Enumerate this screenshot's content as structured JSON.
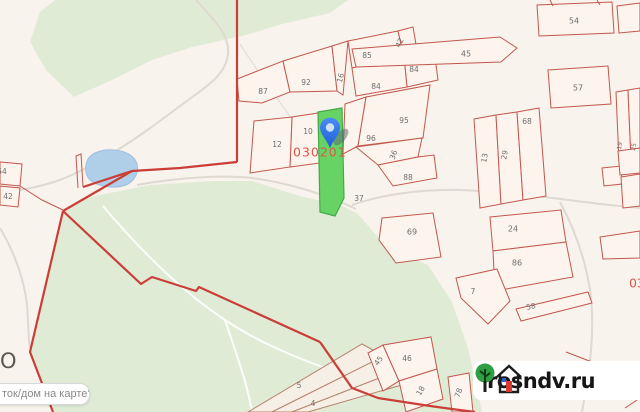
{
  "map": {
    "colors": {
      "background": "#f8f3ec",
      "forest_green": "#e0ebd6",
      "water_blue": "#afcfe9",
      "parcel_line_red": "#c2574e",
      "boundary_red": "#cb3e38",
      "brown_line": "#b5836b",
      "highlight_green": "#68d365",
      "highlight_border": "#43a94a",
      "quarter_text_red": "#e2544a",
      "label_gray": "#6e6e6e",
      "pin_blue": "#2e76e9"
    },
    "labels": [
      {
        "t": "87",
        "x": 263,
        "y": 92
      },
      {
        "t": "92",
        "x": 306,
        "y": 83
      },
      {
        "t": "16",
        "x": 341,
        "y": 78,
        "r": -75
      },
      {
        "t": "85",
        "x": 367,
        "y": 56
      },
      {
        "t": "42",
        "x": 400,
        "y": 43,
        "r": -65
      },
      {
        "t": "84",
        "x": 414,
        "y": 70
      },
      {
        "t": "84",
        "x": 376,
        "y": 87
      },
      {
        "t": "95",
        "x": 404,
        "y": 121
      },
      {
        "t": "96",
        "x": 371,
        "y": 139
      },
      {
        "t": "36",
        "x": 394,
        "y": 155,
        "r": -70
      },
      {
        "t": "88",
        "x": 408,
        "y": 178
      },
      {
        "t": "37",
        "x": 359,
        "y": 199
      },
      {
        "t": "10",
        "x": 308,
        "y": 132
      },
      {
        "t": "12",
        "x": 277,
        "y": 145
      },
      {
        "t": "45",
        "x": 466,
        "y": 54,
        "s": 8
      },
      {
        "t": "54",
        "x": 574,
        "y": 21,
        "s": 8
      },
      {
        "t": "57",
        "x": 578,
        "y": 88,
        "s": 8
      },
      {
        "t": "68",
        "x": 527,
        "y": 122
      },
      {
        "t": "13",
        "x": 485,
        "y": 158,
        "r": -80
      },
      {
        "t": "29",
        "x": 505,
        "y": 155,
        "r": -80
      },
      {
        "t": "19",
        "x": 620,
        "y": 146,
        "r": -80,
        "s": 6
      },
      {
        "t": "25",
        "x": 634,
        "y": 147,
        "r": -80,
        "s": 6
      },
      {
        "t": "24",
        "x": 513,
        "y": 229,
        "s": 8
      },
      {
        "t": "86",
        "x": 517,
        "y": 263,
        "s": 8
      },
      {
        "t": "58",
        "x": 531,
        "y": 307,
        "r": -12
      },
      {
        "t": "7",
        "x": 473,
        "y": 292
      },
      {
        "t": "69",
        "x": 412,
        "y": 232,
        "s": 8
      },
      {
        "t": "46",
        "x": 407,
        "y": 359
      },
      {
        "t": "45",
        "x": 379,
        "y": 361,
        "r": -55
      },
      {
        "t": "18",
        "x": 421,
        "y": 391,
        "r": -60
      },
      {
        "t": "78",
        "x": 459,
        "y": 393,
        "r": -70
      },
      {
        "t": "5",
        "x": 299,
        "y": 386
      },
      {
        "t": "4",
        "x": 313,
        "y": 404
      },
      {
        "t": "54",
        "x": 2,
        "y": 172
      },
      {
        "t": "42",
        "x": 8,
        "y": 197
      },
      {
        "t": "030201",
        "x": 293,
        "y": 153,
        "c": "#e2544a",
        "s": 12.5,
        "a": "start",
        "ls": 1
      },
      {
        "t": "03",
        "x": 629,
        "y": 284,
        "c": "#e2544a",
        "s": 12.5,
        "a": "start"
      },
      {
        "t": "О",
        "x": 0,
        "y": 362,
        "c": "#5b5751",
        "s": 21,
        "a": "start"
      }
    ]
  },
  "search_box": {
    "text": "ток/дом на карте?"
  },
  "watermark": {
    "text": "rosndv.ru"
  }
}
